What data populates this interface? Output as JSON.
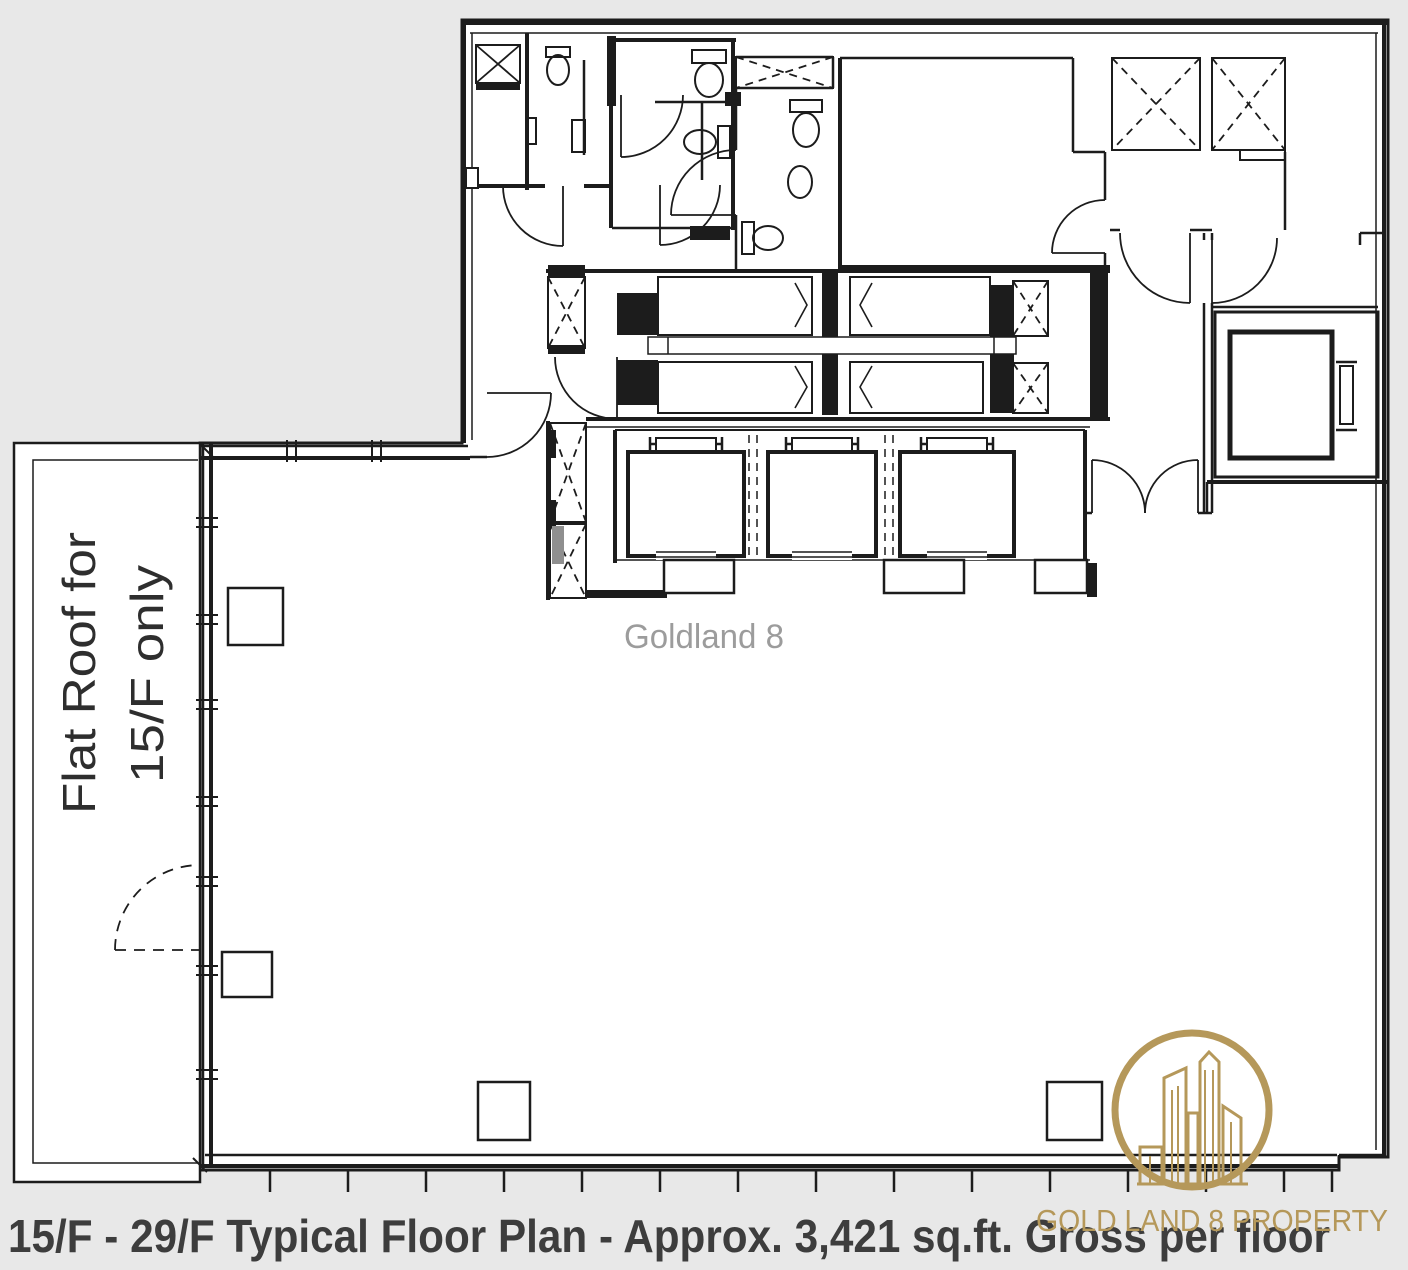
{
  "colors": {
    "background": "#e8e8e8",
    "plan-fill": "#ffffff",
    "line": "#1c1c1c",
    "watermark": "#9c9c9c",
    "label": "#2e2e2e",
    "caption": "#3d3d3d",
    "gold": "#b5985a",
    "shaft-gray": "#8f8f8f"
  },
  "plan": {
    "watermark_text": "Goldland 8",
    "flat_roof_label_line1": "Flat Roof for",
    "flat_roof_label_line2": "15/F only"
  },
  "caption": {
    "text": "15/F - 29/F Typical Floor Plan - Approx. 3,421 sq.ft. Gross per floor"
  },
  "branding": {
    "logo_text": "GOLD LAND 8 PROPERTY"
  }
}
